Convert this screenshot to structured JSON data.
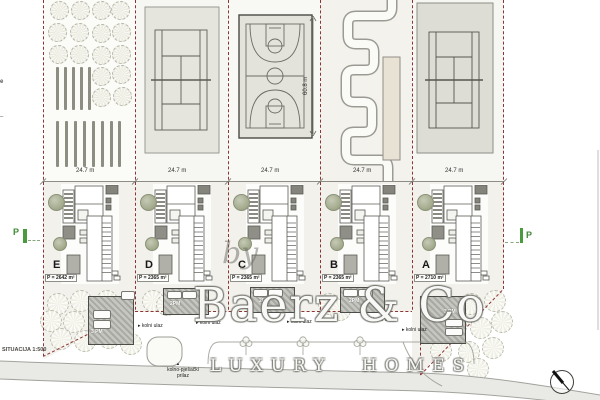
{
  "drawing": {
    "scale_label": "SITUACIJA 1:500",
    "north_arrow_icon": "compass-north"
  },
  "watermark": {
    "prefix": "by",
    "brand": "Baerz & Co",
    "tagline": "LUXURY HOMES"
  },
  "dimensions": {
    "plot_widths": [
      "24.7 m",
      "24.7 m",
      "24.7 m",
      "24.7 m",
      "24.7 m"
    ],
    "court_depth": "60.8 m"
  },
  "villas": [
    {
      "label": "E",
      "area": "P = 2642 m²",
      "parking": "3 PM"
    },
    {
      "label": "D",
      "area": "P = 2365 m²",
      "parking": "2PM"
    },
    {
      "label": "C",
      "area": "P = 2365 m²",
      "parking": "2PM"
    },
    {
      "label": "B",
      "area": "P = 2365 m²",
      "parking": "2PM"
    },
    {
      "label": "A",
      "area": "P = 2710 m²",
      "parking": "3 PM"
    }
  ],
  "amenities": {
    "plot_1": "orchard-garden",
    "plot_2": "tennis-court",
    "plot_3": "basketball-court",
    "plot_4": "go-kart-track",
    "plot_5": "tennis-court"
  },
  "road": {
    "entrance_label": "kolni ulaz",
    "entrance_arrow": "▸",
    "access_label_line1": "kolno-pješački",
    "access_label_line2": "prilaz",
    "access_marker": "▲"
  },
  "markers": {
    "parking_p": "P",
    "edge_fragment_1": "e",
    "edge_fragment_2": "–"
  },
  "colors": {
    "boundary_red": "#8d3535",
    "marker_green": "#4a9a3e",
    "court_fill": "#e4e3db",
    "parking_fill": "#a9a9a4",
    "road_fill": "#e9e9e5",
    "plot_fill": "#f2f1ec"
  }
}
